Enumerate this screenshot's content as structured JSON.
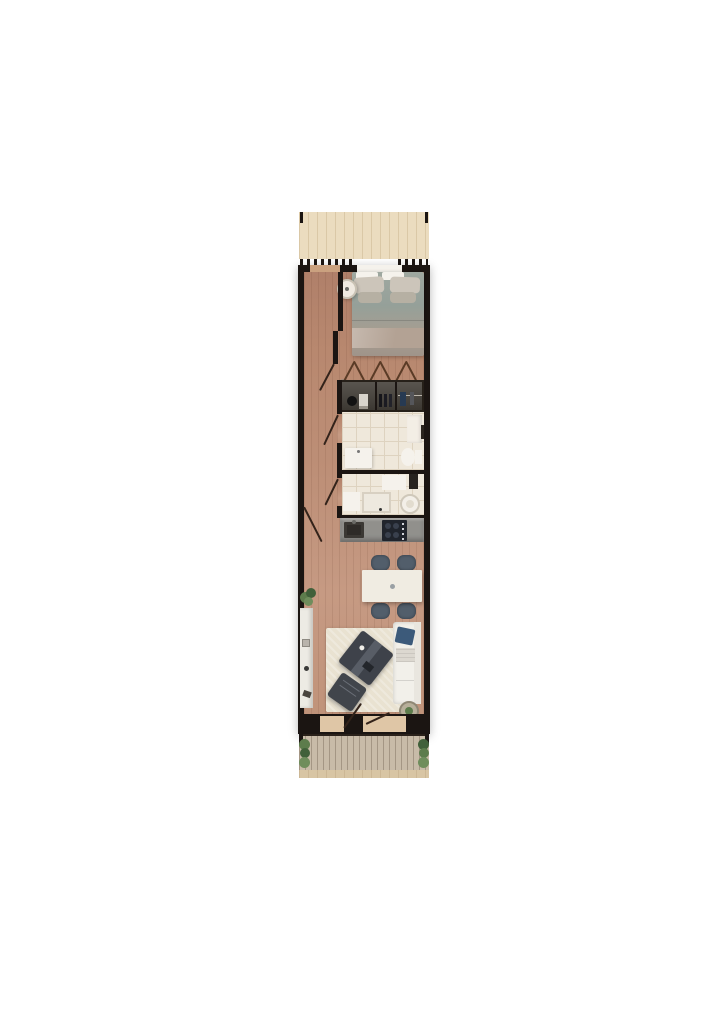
{
  "scene": {
    "type": "floor-plan-render",
    "view": "top-down-3d",
    "subject": "narrow studio apartment / tiny house"
  },
  "palette": {
    "background": "#ffffff",
    "wall": "#1b1512",
    "floor": "#bd8f77",
    "deck_top": "#ebdcbf",
    "deck_bottom": "#c8bba8",
    "bottom_strip": "#d8c5a4",
    "tile": "#efe8db",
    "tile_line": "#ded3c0",
    "counter": "#91908c",
    "appliance_dark": "#20242c",
    "sink_dark": "#3b3834",
    "closet_dark": "#262019",
    "bed_duvet": "#9aa49d",
    "pillow_light": "#ccc5ba",
    "pillow_dark": "#b6b0a3",
    "blanket": "#b3a294",
    "rug": "#e9e2d1",
    "sofa": "#f2f0ea",
    "cushion_navy": "#3c5a7a",
    "chair": "#525e6b",
    "table": "#f0ece2",
    "white_fixture": "#f5f2ec",
    "plant": "#5d7c4c",
    "plant_dark": "#41603a",
    "door_swing": "#5a3b26"
  },
  "rooms": {
    "terrace_top": {
      "name": "top terrace deck",
      "furniture": []
    },
    "bedroom": {
      "name": "bedroom",
      "furniture": [
        "double-bed",
        "pillows",
        "round-nightstand",
        "stool",
        "window-headboard"
      ]
    },
    "hallway": {
      "name": "hallway",
      "furniture": []
    },
    "wardrobe": {
      "name": "wardrobe closet",
      "furniture": [
        "shelves",
        "folded-clothes",
        "shoes",
        "hanging-rail",
        "bag"
      ]
    },
    "bathroom": {
      "name": "bathroom",
      "furniture": [
        "vanity-sink",
        "toilet",
        "shelf-column",
        "radiator"
      ]
    },
    "shower_room": {
      "name": "shower and laundry room",
      "furniture": [
        "shower-tray",
        "washing-machine",
        "cabinet",
        "counter"
      ]
    },
    "kitchen": {
      "name": "kitchen",
      "furniture": [
        "countertop",
        "sink",
        "cooktop"
      ]
    },
    "dining": {
      "name": "dining area",
      "furniture": [
        "dining-table",
        "chair",
        "chair",
        "chair",
        "chair"
      ]
    },
    "living": {
      "name": "living room",
      "furniture": [
        "rug",
        "coffee-table",
        "lounge-chair",
        "sofa",
        "navy-cushion",
        "sideboard",
        "plant",
        "side-table-plant"
      ]
    },
    "terrace_bottom": {
      "name": "bottom terrace deck",
      "furniture": [
        "planter-left",
        "planter-right"
      ]
    }
  },
  "doors": [
    "balcony-opening-top",
    "bedroom-door",
    "wardrobe-folding-doors",
    "bathroom-door",
    "shower-room-door",
    "entrance-door-left",
    "terrace-door-left",
    "terrace-door-right"
  ]
}
